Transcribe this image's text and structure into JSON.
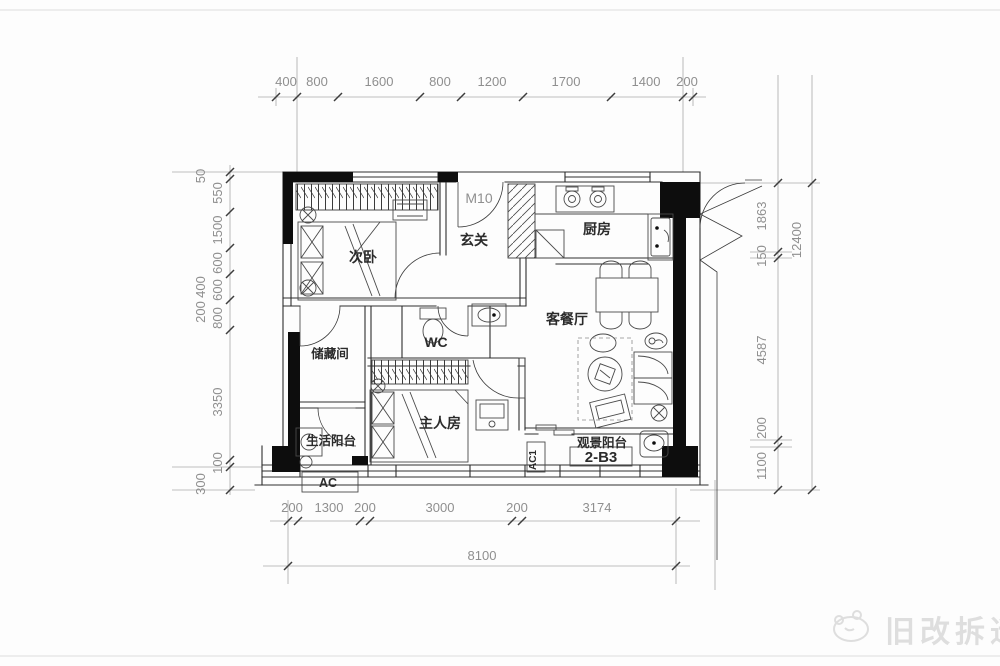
{
  "plan": {
    "unit_label": "2-B3",
    "entry_door_label": "M10",
    "rooms": {
      "secondary_bedroom": "次卧",
      "entry_hall": "玄关",
      "kitchen": "厨房",
      "living_dining": "客餐厅",
      "storage": "储藏间",
      "wc": "WC",
      "master_bedroom": "主人房",
      "life_balcony": "生活阳台",
      "view_balcony": "观景阳台",
      "ac_unit": "AC",
      "ac_unit_1": "AC1"
    }
  },
  "dims": {
    "top": [
      "400",
      "800",
      "1600",
      "800",
      "1200",
      "1700",
      "1400",
      "200"
    ],
    "bottom": [
      "200",
      "1300",
      "200",
      "3000",
      "200",
      "3174"
    ],
    "bottom_total": "8100",
    "left_inner": [
      "550",
      "1500",
      "600",
      "600",
      "800",
      "3350",
      "100"
    ],
    "left_outer": [
      "50",
      "400",
      "200",
      "300"
    ],
    "right_inner": [
      "1863",
      "150",
      "4587",
      "200",
      "1100"
    ],
    "right_total": "12400"
  },
  "watermark": {
    "text": "旧改拆迁"
  },
  "colors": {
    "line": "#2e2e2e",
    "dim_text": "#8f8f8f",
    "poche": "#0d0d0d",
    "watermark": "#dedede"
  }
}
